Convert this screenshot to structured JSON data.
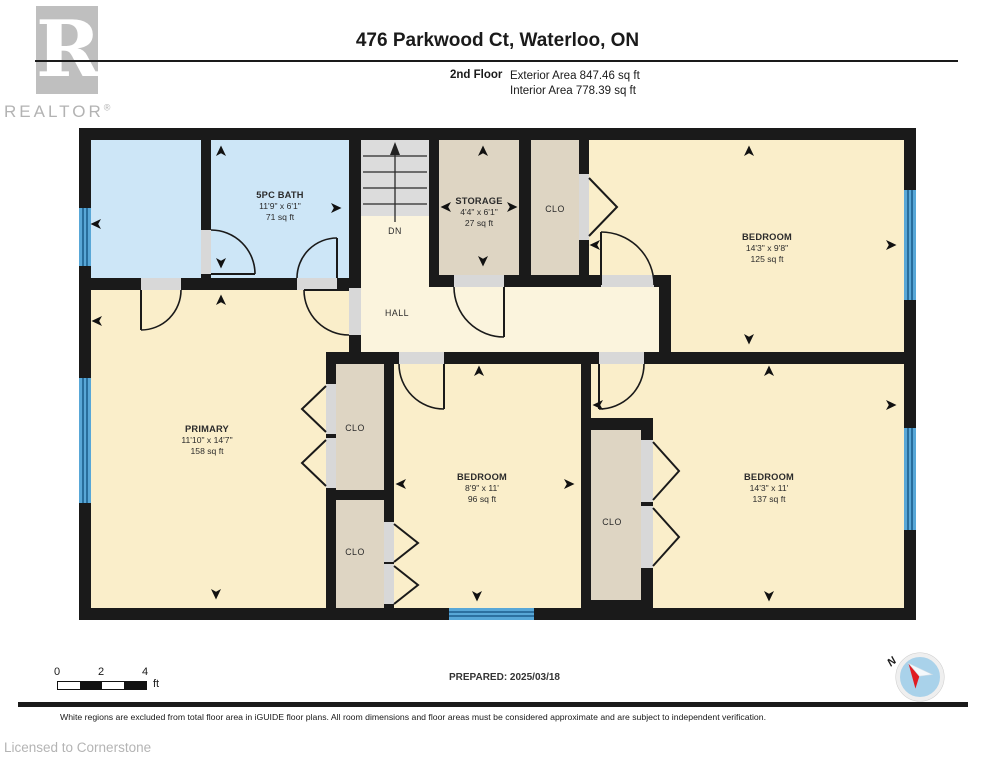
{
  "header": {
    "title": "476 Parkwood Ct, Waterloo, ON",
    "floor_label": "2nd Floor",
    "exterior_area": "Exterior Area 847.46 sq ft",
    "interior_area": "Interior Area 778.39 sq ft"
  },
  "logo": {
    "letter": "R",
    "text": "REALTOR",
    "mark": "®"
  },
  "plan": {
    "rooms": {
      "bath": {
        "name": "5PC BATH",
        "dims": "11'9\" x 6'1\"",
        "area": "71 sq ft"
      },
      "storage": {
        "name": "STORAGE",
        "dims": "4'4\" x 6'1\"",
        "area": "27 sq ft"
      },
      "clo_top": {
        "name": "CLO"
      },
      "bedroom_tr": {
        "name": "BEDROOM",
        "dims": "14'3\" x 9'8\"",
        "area": "125 sq ft"
      },
      "hall": {
        "name": "HALL"
      },
      "stairs": {
        "label": "DN"
      },
      "primary": {
        "name": "PRIMARY",
        "dims": "11'10\" x 14'7\"",
        "area": "158 sq ft"
      },
      "clo_ml_a": {
        "name": "CLO"
      },
      "clo_ml_b": {
        "name": "CLO"
      },
      "bedroom_mid": {
        "name": "BEDROOM",
        "dims": "8'9\" x 11'",
        "area": "96 sq ft"
      },
      "clo_mr": {
        "name": "CLO"
      },
      "bedroom_br": {
        "name": "BEDROOM",
        "dims": "14'3\" x 11'",
        "area": "137 sq ft"
      }
    }
  },
  "footer": {
    "scale": {
      "ticks": [
        "0",
        "2",
        "4"
      ],
      "unit": "ft"
    },
    "prepared": "PREPARED: 2025/03/18",
    "compass_label": "N",
    "disclaimer": "White regions are excluded from total floor area in iGUIDE floor plans. All room dimensions and floor areas must be considered approximate and are subject to independent verification.",
    "license": "Licensed to Cornerstone"
  },
  "colors": {
    "wall": "#1a1a1a",
    "room_beige": "#faeeca",
    "hall_cream": "#fbf4dd",
    "room_blue": "#cde6f7",
    "closet_tan": "#ded5c3",
    "window_blue": "#58a7d7",
    "compass_red": "#e01b22"
  }
}
